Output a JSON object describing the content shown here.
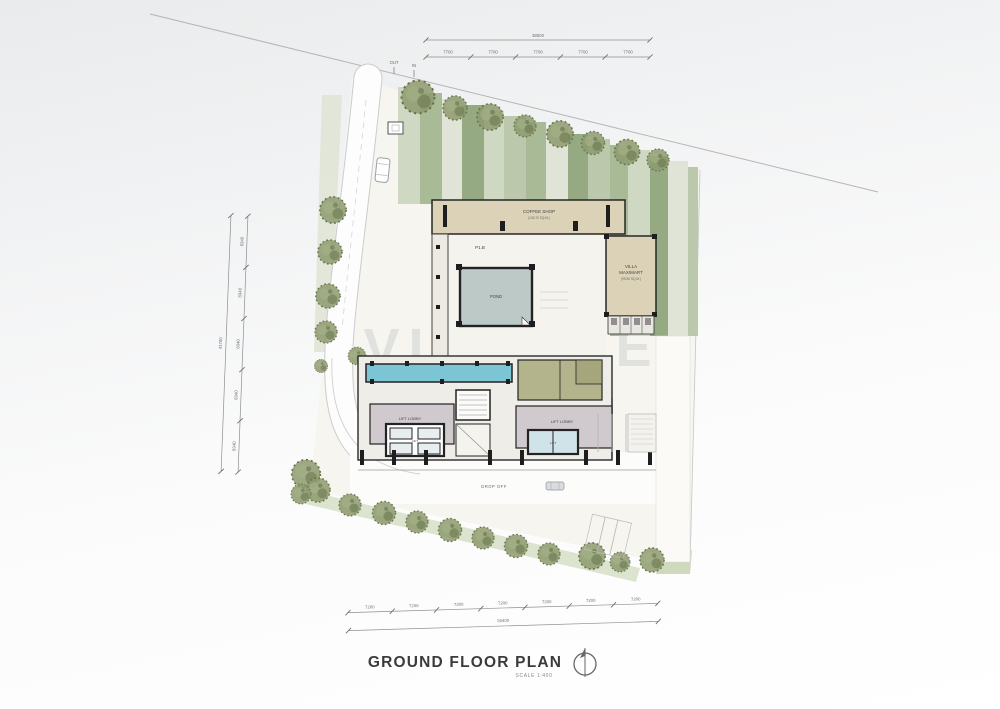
{
  "watermark": "VILORTE",
  "title": {
    "text": "GROUND FLOOR PLAN",
    "scale": "SCALE 1:400"
  },
  "site": {
    "entry_out": "OUT",
    "entry_in": "IN",
    "drop_off": "DROP OFF"
  },
  "rooms": {
    "coffee_shop": "COFFEE SHOP",
    "coffee_shop_area": "(136.70 SQ.M.)",
    "villa_1": "VILLA",
    "villa_2": "MAXIMART",
    "villa_area": "(95.50 SQ.M.)",
    "p1b": "P1.B",
    "pond": "POND",
    "lift_lobby_west": "LIFT LOBBY",
    "lift_lobby_east": "LIFT LOBBY",
    "lift_west": "LIFT",
    "lift_east": "LIFT"
  },
  "dims": {
    "top": {
      "total": "38500",
      "segments": [
        "7700",
        "7700",
        "7700",
        "7700",
        "7700"
      ]
    },
    "bottom": {
      "total": "50400",
      "segments": [
        "7200",
        "7200",
        "7200",
        "7200",
        "7200",
        "7200",
        "7200"
      ]
    },
    "left": {
      "total": "41700",
      "segments": [
        "8340",
        "8340",
        "8340",
        "8340",
        "8340"
      ]
    }
  },
  "colors": {
    "ground": "#f6f5f0",
    "wall": "#262626",
    "tan": "#dbd2b8",
    "olive": "#b4b48c",
    "lavender": "#d0c9cd",
    "pool": "#7cc5d4",
    "pond": "#bcc9c7",
    "green_dark": "#95aa82",
    "green_light": "#e0e4d6"
  }
}
